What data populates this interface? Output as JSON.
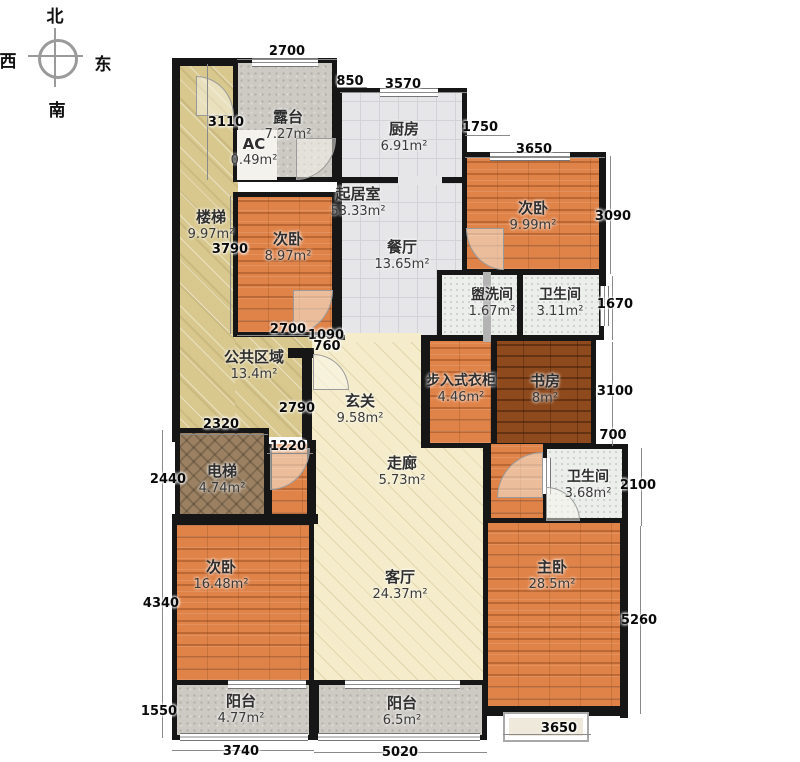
{
  "compass": {
    "north": "北",
    "south": "南",
    "east": "东",
    "west": "西"
  },
  "rooms": {
    "terrace": {
      "name": "露台",
      "area": "7.27m²"
    },
    "ac": {
      "name": "AC",
      "area": "0.49m²"
    },
    "kitchen": {
      "name": "厨房",
      "area": "6.91m²"
    },
    "living": {
      "name": "起居室",
      "area": "53.33m²"
    },
    "stairs": {
      "name": "楼梯",
      "area": "9.97m²"
    },
    "bedroom_nw": {
      "name": "次卧",
      "area": "8.97m²"
    },
    "dining": {
      "name": "餐厅",
      "area": "13.65m²"
    },
    "bedroom_ne": {
      "name": "次卧",
      "area": "9.99m²"
    },
    "washroom": {
      "name": "盥洗间",
      "area": "1.67m²"
    },
    "bath_north": {
      "name": "卫生间",
      "area": "3.11m²"
    },
    "public": {
      "name": "公共区域",
      "area": "13.4m²"
    },
    "foyer": {
      "name": "玄关",
      "area": "9.58m²"
    },
    "closet": {
      "name": "步入式衣柜",
      "area": "4.46m²"
    },
    "study": {
      "name": "书房",
      "area": "8m²"
    },
    "elevator": {
      "name": "电梯",
      "area": "4.74m²"
    },
    "corridor": {
      "name": "走廊",
      "area": "5.73m²"
    },
    "bath_east": {
      "name": "卫生间",
      "area": "3.68m²"
    },
    "bedroom_sw": {
      "name": "次卧",
      "area": "16.48m²"
    },
    "living_room": {
      "name": "客厅",
      "area": "24.37m²"
    },
    "master": {
      "name": "主卧",
      "area": "28.5m²"
    },
    "balcony_w": {
      "name": "阳台",
      "area": "4.77m²"
    },
    "balcony_e": {
      "name": "阳台",
      "area": "6.5m²"
    }
  },
  "dimensions": {
    "top": {
      "a": "2700",
      "b": "850",
      "c": "3570",
      "d": "1750",
      "e": "3650"
    },
    "left": {
      "a": "3110",
      "b": "3790",
      "c": "2700",
      "d": "1090",
      "e": "760",
      "f": "2790",
      "g": "2320",
      "h": "1220",
      "i": "2440",
      "j": "4340",
      "k": "1550"
    },
    "right": {
      "a": "3090",
      "b": "1670",
      "c": "3100",
      "d": "700",
      "e": "2100",
      "f": "5260"
    },
    "bottom": {
      "a": "3740",
      "b": "5020",
      "c": "3650"
    }
  },
  "colors": {
    "wall": "#161616",
    "wood": "#df8349",
    "wood_dark": "#8e4a1d",
    "tan": "#d8c88e",
    "cream": "#f4ecca",
    "tile": "#e6e6e8"
  }
}
